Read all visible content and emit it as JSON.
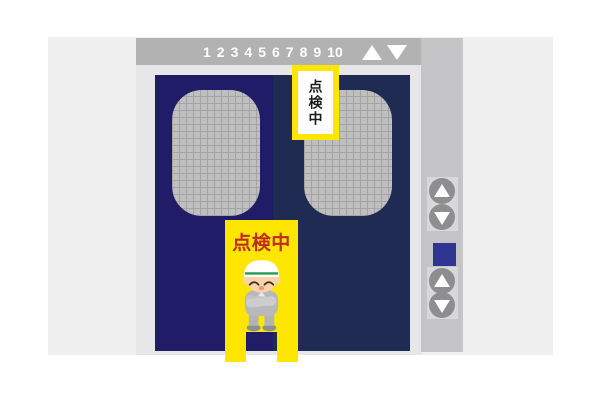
{
  "indicator_panel": {
    "floors": [
      "1",
      "2",
      "3",
      "4",
      "5",
      "6",
      "7",
      "8",
      "9",
      "10"
    ],
    "up_icon": "white-up-triangle",
    "down_icon": "white-down-triangle",
    "panel_color": "#b2b2b2"
  },
  "elevator": {
    "left_door_color": "#211c68",
    "right_door_color": "#1f2b52",
    "window_style": "wired-glass-grid",
    "frame_color": "#e7e7e9",
    "wall_color": "#f0f0f1"
  },
  "door_sign": {
    "text": "点検中",
    "orientation": "vertical",
    "background": "#ffe600",
    "inner_background": "#ffffff",
    "text_color": "#1c1c1c"
  },
  "floor_sign": {
    "text": "点検中",
    "background": "#ffe600",
    "text_color": "#c12a1f",
    "character": "resting-maintenance-worker"
  },
  "call_panel": {
    "upper_buttons": [
      "up",
      "down"
    ],
    "lower_buttons": [
      "up",
      "down"
    ],
    "button_color": "#8e8e90",
    "indicator_color": "#2f3590"
  }
}
